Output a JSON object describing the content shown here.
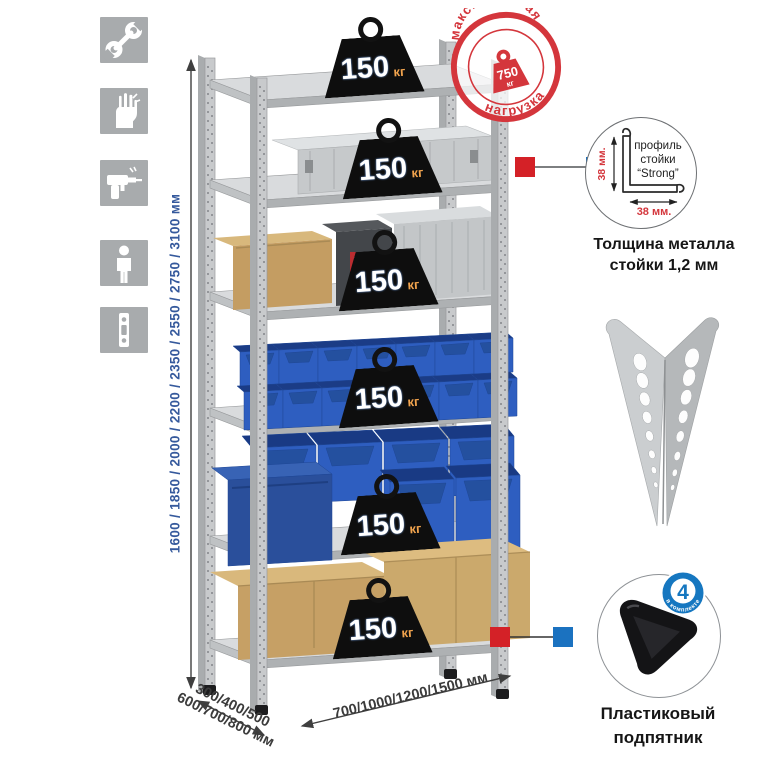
{
  "toolbar": {
    "icons": [
      "wrench-icon",
      "gloves-icon",
      "drill-icon",
      "person-icon",
      "rack-profile-icon"
    ]
  },
  "dims": {
    "height": "1600 / 1850 / 2000 / 2200 / 2350 / 2550 / 2750 / 3100 мм",
    "depth1": "300/400/500",
    "depth2": "600/700/800 мм",
    "width": "700/1000/1200/1500 мм"
  },
  "shelves": [
    {
      "load": "150",
      "unit": "кг"
    },
    {
      "load": "150",
      "unit": "кг"
    },
    {
      "load": "150",
      "unit": "кг"
    },
    {
      "load": "150",
      "unit": "кг"
    },
    {
      "load": "150",
      "unit": "кг"
    },
    {
      "load": "150",
      "unit": "кг"
    }
  ],
  "stamp": {
    "top": "максимальная",
    "bottom": "нагрузка",
    "value": "750",
    "unit": "кг"
  },
  "profile": {
    "l1": "профиль",
    "l2": "стойки",
    "l3": "“Strong”",
    "dimv": "38 мм.",
    "dimh": "38 мм.",
    "cap1": "Толщина металла",
    "cap2": "стойки 1,2 мм"
  },
  "foot": {
    "badge": "4",
    "badge_text": "в комплекте",
    "cap1": "Пластиковый",
    "cap2": "подпятник"
  },
  "colors": {
    "accent_red": "#d4363c",
    "accent_blue": "#1b72c0",
    "dim_text_blue": "#35599c",
    "metal_gray": "#c8cacc",
    "bin_blue": "#2e5ec0"
  }
}
